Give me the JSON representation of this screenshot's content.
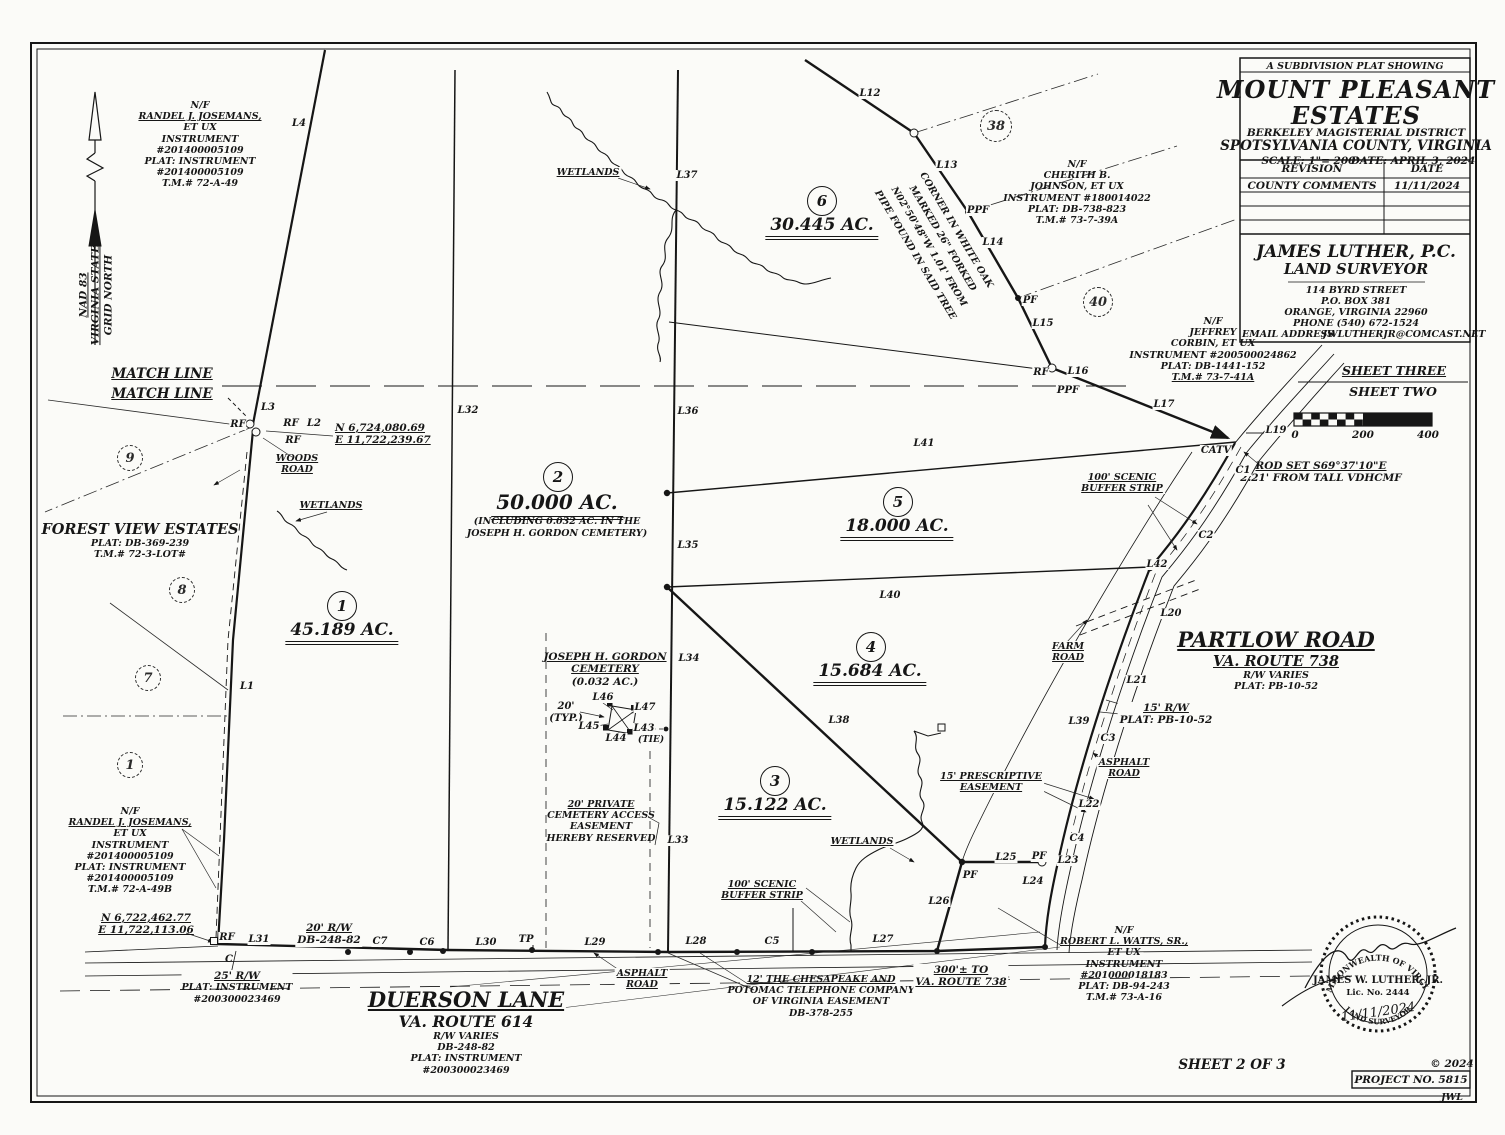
{
  "title_block": {
    "kicker": "A SUBDIVISION PLAT SHOWING",
    "name_line1": "MOUNT PLEASANT",
    "name_line2": "ESTATES",
    "district": "BERKELEY MAGISTERIAL DISTRICT",
    "county": "SPOTSYLVANIA COUNTY, VIRGINIA",
    "scale": "SCALE: 1\"= 200'",
    "date": "DATE: APRIL 3, 2024"
  },
  "revision_table": {
    "headers": [
      "REVISION",
      "DATE"
    ],
    "rows": [
      [
        "COUNTY COMMENTS",
        "11/11/2024"
      ]
    ]
  },
  "surveyor": {
    "name": "JAMES LUTHER, P.C.",
    "title": "LAND SURVEYOR",
    "address1": "114 BYRD STREET",
    "address2": "P.O. BOX 381",
    "address3": "ORANGE, VIRGINIA 22960",
    "phone": "PHONE (540) 672-1524",
    "email_label": "EMAIL ADDRESS",
    "email": "JWLUTHERJR@COMCAST.NET"
  },
  "sheet_divider": {
    "top": "SHEET THREE",
    "bottom": "SHEET TWO"
  },
  "scale_bar": {
    "ticks": [
      "0",
      "200",
      "400"
    ]
  },
  "north_arrow": {
    "line1": "NAD 83",
    "line2": "VIRGINIA STATE",
    "line3": "GRID NORTH"
  },
  "match_line": {
    "top": "MATCH LINE",
    "bottom": "MATCH LINE"
  },
  "parcels": [
    {
      "number": "1",
      "acreage": "45.189 AC."
    },
    {
      "number": "2",
      "acreage": "50.000 AC.",
      "note1": "(INCLUDING 0.032 AC. IN THE",
      "note2": "JOSEPH H. GORDON CEMETERY)"
    },
    {
      "number": "3",
      "acreage": "15.122 AC."
    },
    {
      "number": "4",
      "acreage": "15.684 AC."
    },
    {
      "number": "5",
      "acreage": "18.000 AC."
    },
    {
      "number": "6",
      "acreage": "30.445 AC."
    }
  ],
  "adjoining_lots": {
    "lot9": "9",
    "lot8": "8",
    "lot7": "7",
    "lot1": "1",
    "lot38": "38",
    "lot40": "40"
  },
  "owners": {
    "josemans_north": [
      "N/F",
      "RANDEL J. JOSEMANS,",
      "ET UX",
      "INSTRUMENT",
      "#201400005109",
      "PLAT: INSTRUMENT",
      "#201400005109",
      "T.M.# 72-A-49"
    ],
    "josemans_south": [
      "N/F",
      "RANDEL J. JOSEMANS,",
      "ET UX",
      "INSTRUMENT",
      "#201400005109",
      "PLAT: INSTRUMENT",
      "#201400005109",
      "T.M.# 72-A-49B"
    ],
    "johnson": [
      "N/F",
      "CHERITH B.",
      "JOHNSON, ET UX",
      "INSTRUMENT #180014022",
      "PLAT: DB-738-823",
      "T.M.# 73-7-39A"
    ],
    "corbin": [
      "N/F",
      "JEFFREY",
      "CORBIN, ET UX",
      "INSTRUMENT #200500024862",
      "PLAT: DB-1441-152",
      "T.M.# 73-7-41A"
    ],
    "watts": [
      "N/F",
      "ROBERT L. WATTS, SR.,",
      "ET UX",
      "INSTRUMENT",
      "#201000018183",
      "PLAT: DB-94-243",
      "T.M.# 73-A-16"
    ],
    "forest_view": [
      "FOREST VIEW ESTATES",
      "PLAT: DB-369-239",
      "T.M.# 72-3-LOT#"
    ]
  },
  "roads": {
    "partlow": [
      "PARTLOW ROAD",
      "VA. ROUTE 738",
      "R/W VARIES",
      "PLAT: PB-10-52"
    ],
    "duerson": [
      "DUERSON LANE",
      "VA. ROUTE 614",
      "R/W VARIES",
      "DB-248-82",
      "PLAT: INSTRUMENT",
      "#200300023469"
    ],
    "woods": [
      "WOODS",
      "ROAD"
    ],
    "farm": [
      "FARM",
      "ROAD"
    ],
    "asphalt": [
      "ASPHALT",
      "ROAD"
    ]
  },
  "coordinates": {
    "north_corner": [
      "N 6,724,080.69",
      "E 11,722,239.67"
    ],
    "south_corner": [
      "N 6,722,462.77",
      "E 11,722,113.06"
    ]
  },
  "cemetery": {
    "line1": "JOSEPH H. GORDON",
    "line2": "CEMETERY",
    "line3": "(0.032 AC.)",
    "dim": "20'",
    "dim2": "(TYP.)"
  },
  "notes": {
    "cemetery_easement": [
      "20' PRIVATE",
      "CEMETERY ACCESS",
      "EASEMENT",
      "HEREBY RESERVED"
    ],
    "phone_easement": [
      "12' THE CHESAPEAKE AND",
      "POTOMAC TELEPHONE COMPANY",
      "OF VIRGINIA EASEMENT",
      "DB-378-255"
    ],
    "scenic_buffer": [
      "100' SCENIC",
      "BUFFER STRIP"
    ],
    "prescriptive": [
      "15' PRESCRIPTIVE",
      "EASEMENT"
    ],
    "rw15": [
      "15' R/W",
      "PLAT: PB-10-52"
    ],
    "rw20": [
      "20' R/W",
      "DB-248-82"
    ],
    "rw25": [
      "25' R/W",
      "PLAT: INSTRUMENT",
      "#200300023469"
    ],
    "rod_set": [
      "ROD SET S69°37'10\"E",
      "2.21' FROM TALL VDHCMF"
    ],
    "corner_oak": [
      "CORNER IN WHITE OAK",
      "MARKED 26\" FORKED",
      "N02°50'48\"W 1.01' FROM",
      "PIPE FOUND IN SAID TREE"
    ],
    "distance_738": [
      "300'± TO",
      "VA. ROUTE 738"
    ],
    "wetlands": "WETLANDS"
  },
  "line_labels": {
    "L1": "L1",
    "L2": "L2",
    "L3": "L3",
    "L4": "L4",
    "L12": "L12",
    "L13": "L13",
    "L14": "L14",
    "L15": "L15",
    "L16": "L16",
    "L17": "L17",
    "L19": "L19",
    "L20": "L20",
    "L21": "L21",
    "L22": "L22",
    "L23": "L23",
    "L24": "L24",
    "L25": "L25",
    "L26": "L26",
    "L27": "L27",
    "L28": "L28",
    "L29": "L29",
    "L30": "L30",
    "L31": "L31",
    "L32": "L32",
    "L33": "L33",
    "L34": "L34",
    "L35": "L35",
    "L36": "L36",
    "L37": "L37",
    "L38": "L38",
    "L39": "L39",
    "L40": "L40",
    "L41": "L41",
    "L42": "L42",
    "L43": "L43",
    "L43_tie": "(TIE)",
    "L44": "L44",
    "L45": "L45",
    "L46": "L46",
    "L47": "L47",
    "C1": "C1",
    "C2": "C2",
    "C3": "C3",
    "C4": "C4",
    "C5": "C5",
    "C6": "C6",
    "C7": "C7"
  },
  "markers": {
    "RF": "RF",
    "PPF": "PPF",
    "PF": "PF",
    "TP": "TP",
    "CATV": "CATV",
    "CL": "C"
  },
  "seal": {
    "ring_top": "COMMONWEALTH OF VIRGINIA",
    "name": "JAMES W. LUTHER, JR.",
    "license": "Lic. No. 2444",
    "date": "11/11/2024",
    "ring_bottom": "LAND SURVEYOR"
  },
  "footer": {
    "sheet": "SHEET 2 OF 3",
    "copyright": "© 2024",
    "project": "PROJECT NO. 5815",
    "initials": "JWL"
  }
}
